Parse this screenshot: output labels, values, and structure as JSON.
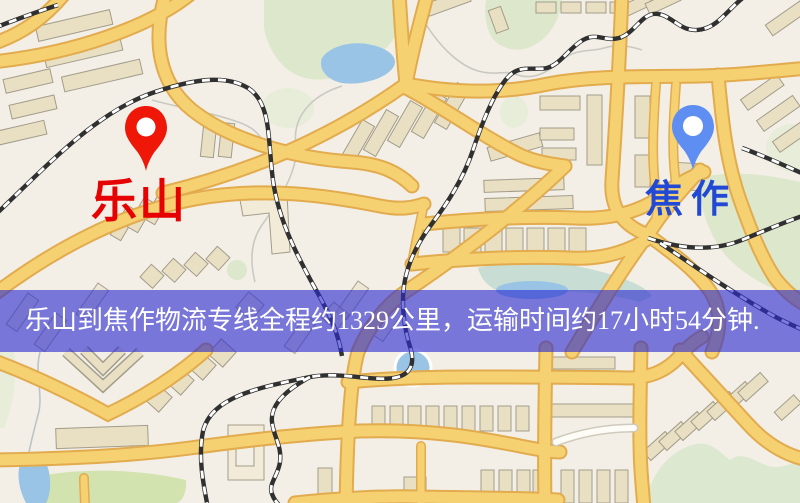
{
  "map": {
    "origin": {
      "name": "乐山",
      "pin_color": "#ee1708",
      "label_color": "#e60202"
    },
    "destination": {
      "name": "焦作",
      "pin_color": "#5f8ef2",
      "label_color": "#2149d6"
    },
    "banner": {
      "text": "乐山到焦作物流专线全程约1329公里，运输时间约17小时54分钟.",
      "background": "rgba(43,43,206,0.62)",
      "text_color": "#ffffff"
    },
    "legend_colors": {
      "background": "#f3efe6",
      "road": "#f5d172",
      "road_casing": "#e2ab4e",
      "water": "#9ac4e6",
      "park": "#dce7cb",
      "railway": "#303030",
      "building": "#e9e0c4"
    }
  }
}
